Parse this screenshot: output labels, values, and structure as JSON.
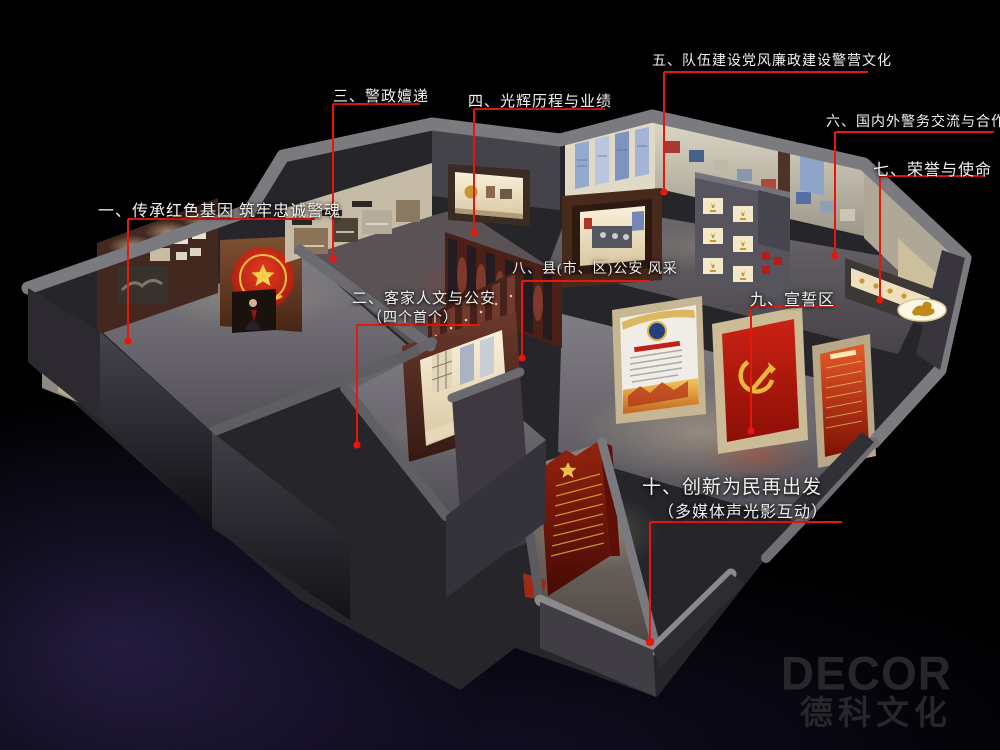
{
  "scene": {
    "description": "3D exhibition hall layout rendering with numbered zone callouts",
    "background": "#000000",
    "annotation_red": "#e8170c",
    "flag_red": "#c21a0e",
    "gold": "#e8b838",
    "wall_gray": "#7d7c81"
  },
  "annotations": [
    {
      "label": "一、传承红色基因 筑牢忠诚警魂",
      "sub": ""
    },
    {
      "label": "二、客家人文与公安",
      "sub": "（四个首个）"
    },
    {
      "label": "三、警政嬗递",
      "sub": ""
    },
    {
      "label": "四、光辉历程与业绩",
      "sub": ""
    },
    {
      "label": "五、队伍建设党风廉政建设警营文化",
      "sub": ""
    },
    {
      "label": "六、国内外警务交流与合作",
      "sub": ""
    },
    {
      "label": "七、荣誉与使命",
      "sub": ""
    },
    {
      "label": "八、县(市、区)公安 风采",
      "sub": ""
    },
    {
      "label": "九、宣誓区",
      "sub": ""
    },
    {
      "label": "十、创新为民再出发",
      "sub": "（多媒体声光影互动）"
    }
  ],
  "watermark": {
    "logo": "DECOR",
    "name": "德科文化"
  }
}
